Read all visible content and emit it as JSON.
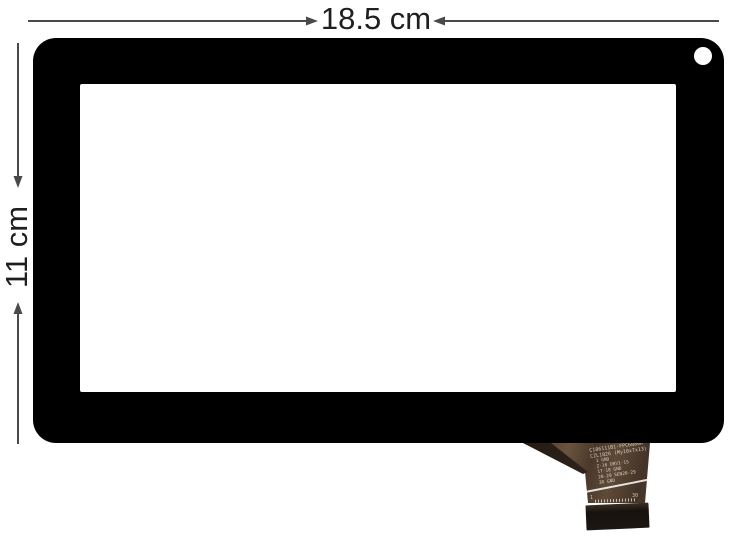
{
  "dimensions": {
    "width_label": "18.5 cm",
    "height_label": "11 cm"
  },
  "flex_cable": {
    "print_lines": [
      "C186111B1-FPC6880R",
      "CZL1826 (My10x7x13)",
      "1 GND",
      "2-16 DRV1-15",
      "17-18 GND",
      "20-29 SEN20-29",
      "30 GND"
    ],
    "pin_first": "1",
    "pin_last": "30"
  },
  "colors": {
    "background": "#ffffff",
    "bezel": "#000000",
    "screen": "#ffffff",
    "annotation_line": "#4a4a4a",
    "annotation_text": "#1f1f1f",
    "cable_base": "#55412f",
    "cable_text": "#d6cdc2",
    "connector": "#1d1713"
  }
}
